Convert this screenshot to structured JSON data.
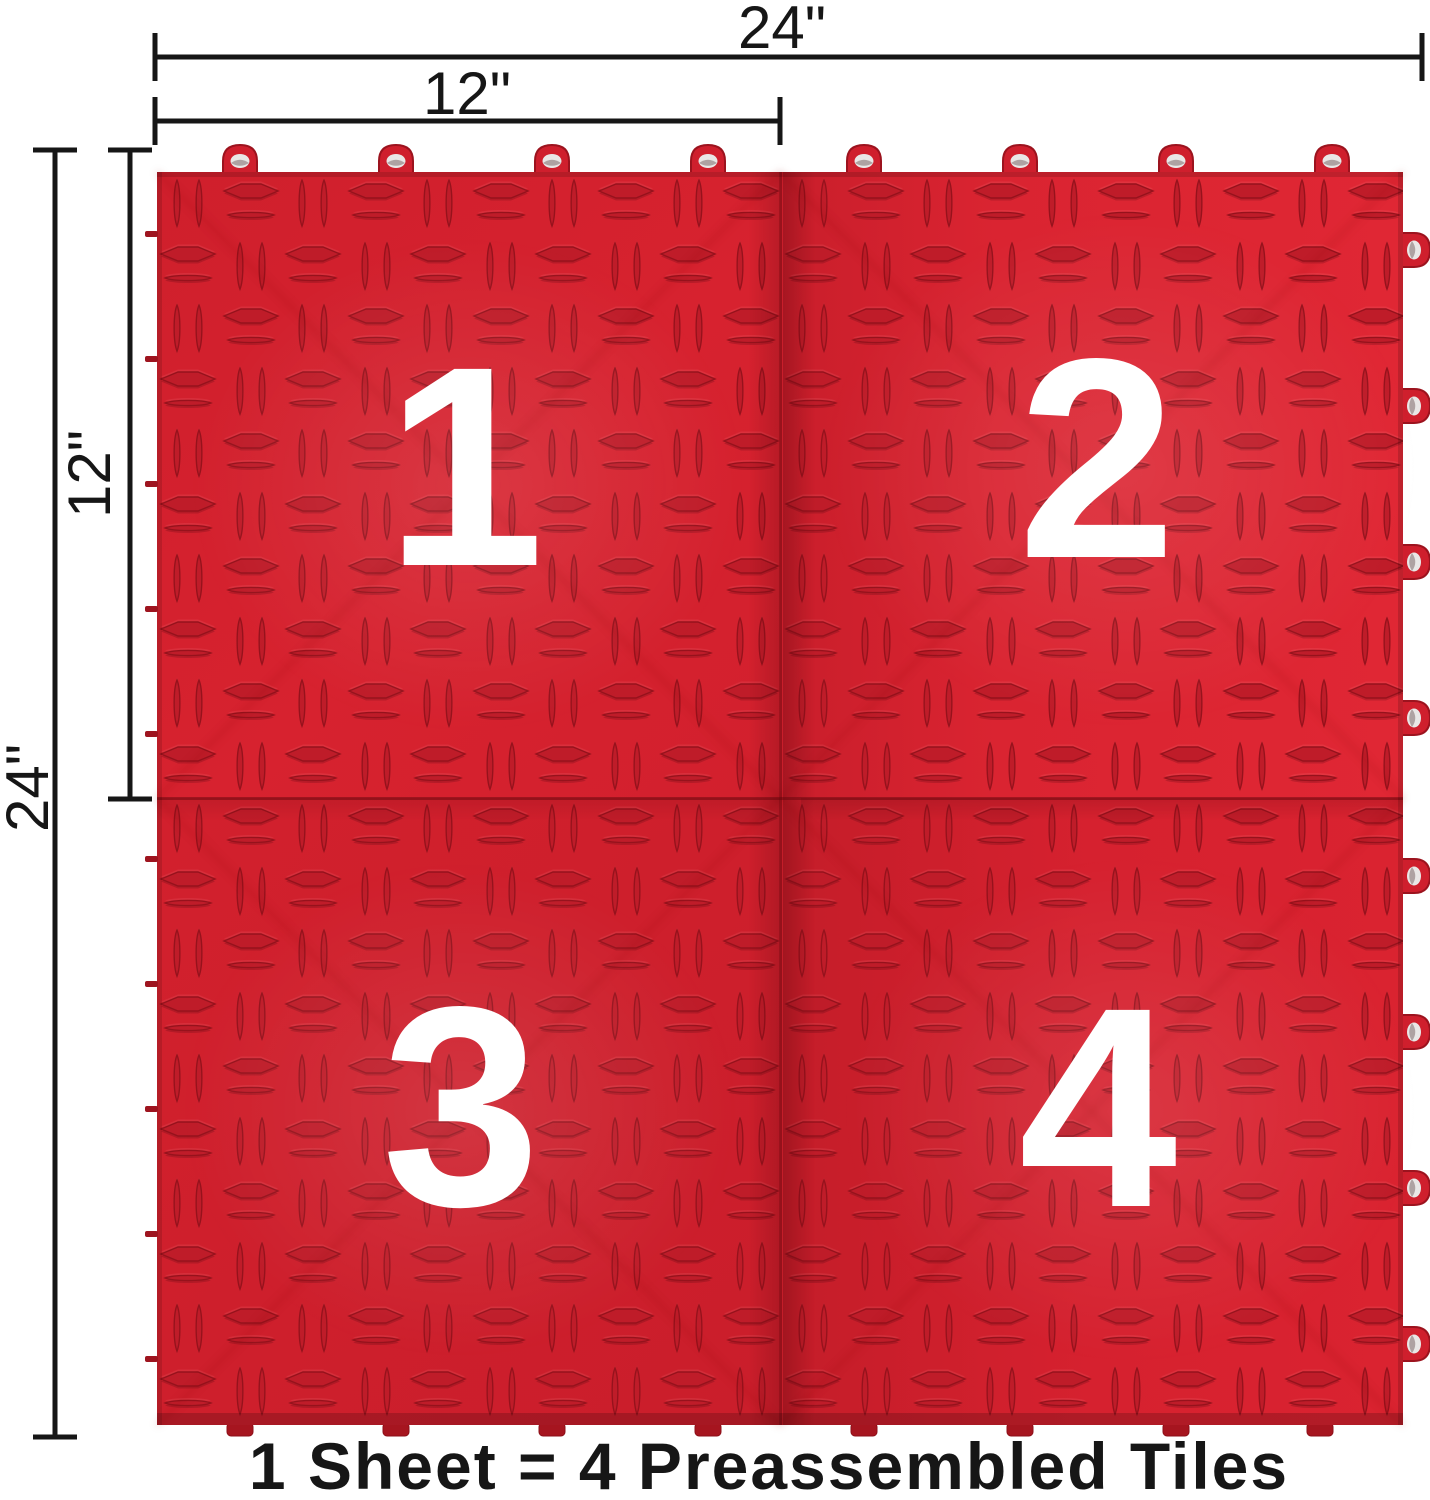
{
  "title": "Interlocking garage floor tile sheet dimension diagram",
  "dimension_labels": {
    "top_width": "24\"",
    "top_half_width": "12\"",
    "side_half_height": "12\"",
    "side_height": "24\""
  },
  "tile_numbers": [
    "1",
    "2",
    "3",
    "4"
  ],
  "caption": "1 Sheet = 4 Preassembled Tiles",
  "colors": {
    "tile_red": "#d6202e",
    "emboss_red": "#bf1c29",
    "emboss_outline": "#96121c",
    "dim_line": "#161616",
    "number_white": "#ffffff",
    "caption_text": "#161616",
    "loop_hole": "#e9e7e6",
    "background": "#ffffff"
  }
}
